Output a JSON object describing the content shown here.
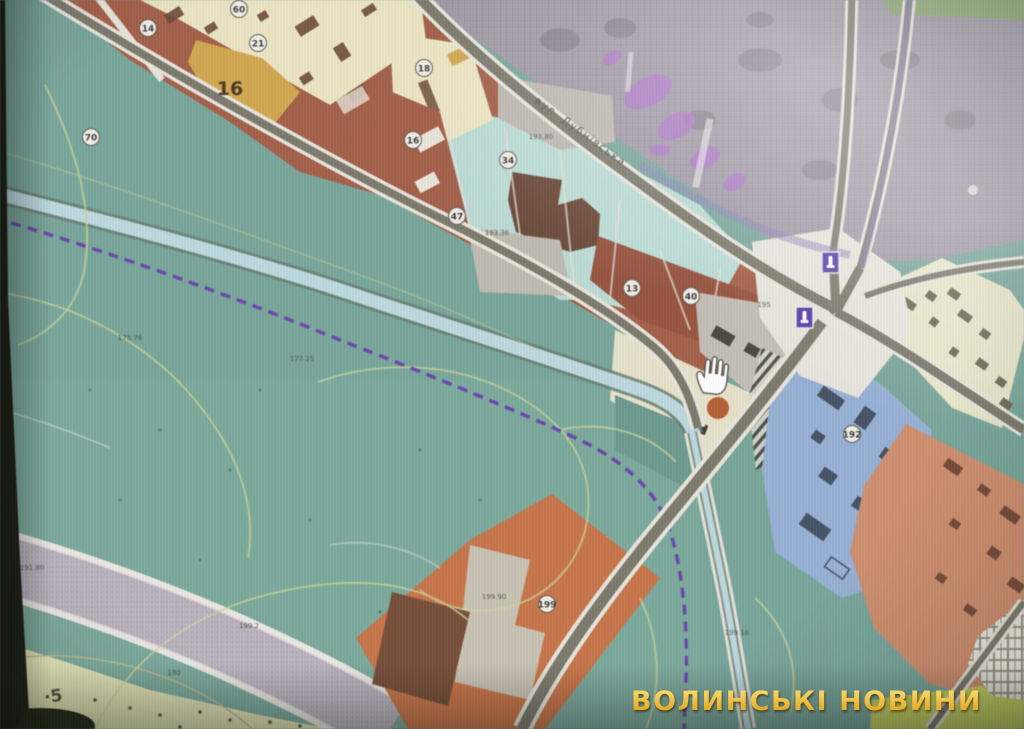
{
  "watermark": {
    "text": "ВОЛИНСЬКІ НОВИНИ",
    "color": "#eab63a"
  },
  "map": {
    "street_label": "вул. Дубнівська",
    "block_house_number": "16",
    "circles": [
      {
        "text": "14"
      },
      {
        "text": "60"
      },
      {
        "text": "21"
      },
      {
        "text": "70"
      },
      {
        "text": "18"
      },
      {
        "text": "16"
      },
      {
        "text": "34"
      },
      {
        "text": "47"
      },
      {
        "text": "13"
      },
      {
        "text": "40"
      },
      {
        "text": "199"
      },
      {
        "text": "192"
      }
    ],
    "area_labels": [
      {
        "text": "193.80"
      },
      {
        "text": "195"
      },
      {
        "text": "199.90"
      },
      {
        "text": "199.16"
      },
      {
        "text": "175.76"
      },
      {
        "text": "177.25"
      },
      {
        "text": "191.80"
      },
      {
        "text": "199.2"
      },
      {
        "text": "190"
      },
      {
        "text": "193.36"
      }
    ],
    "scribble_label": "·5",
    "colors": {
      "park_teal": "#70a79a",
      "river_blue": "#b7dae3",
      "urban_brown": "#ad5a3e",
      "cream_block": "#eee6bd",
      "ochre_building": "#d9a63c",
      "pale_cyan_block": "#b7ddd5",
      "blue_zone": "#8fb0dd",
      "salmon_zone": "#d98a64",
      "orange_zone": "#d4703c",
      "boundary_dash_purple": "#6a2fc2",
      "marker_purple": "#5636bd",
      "road_gray": "#7b7868",
      "watermark_gold": "#eab63a"
    }
  }
}
